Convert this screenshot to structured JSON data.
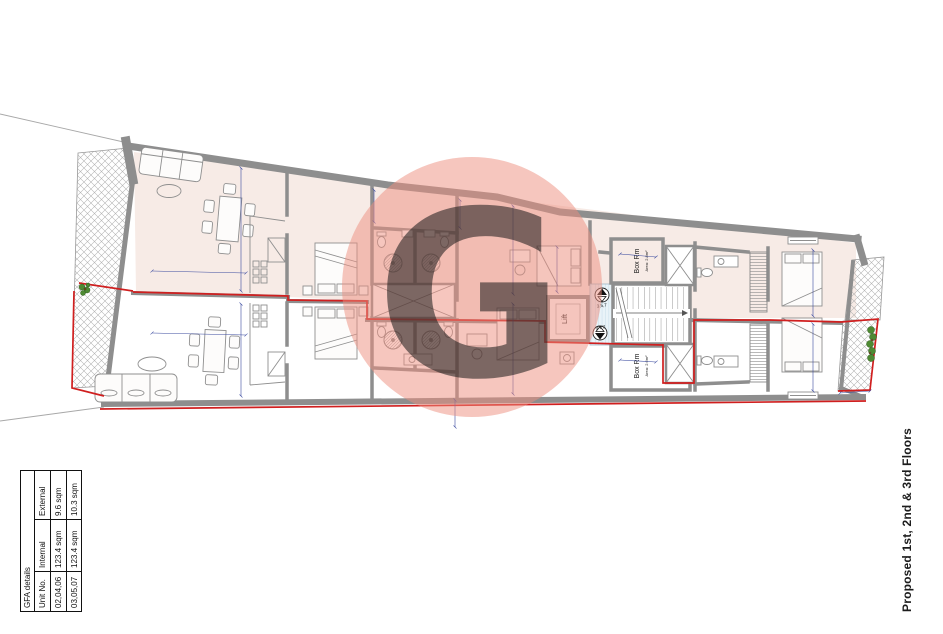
{
  "sheet": {
    "title_vertical": "Proposed 1st, 2nd & 3rd Floors"
  },
  "watermark": {
    "letter": "G",
    "color": "#ee8e7d"
  },
  "gfa_table": {
    "title": "GFA details",
    "columns": [
      "Unit No.",
      "Internal",
      "External"
    ],
    "rows": [
      {
        "unit_no": "02,04,06",
        "internal": "123.4 sqm",
        "external": "9.6 sqm"
      },
      {
        "unit_no": "03,05,07",
        "internal": "123.4 sqm",
        "external": "10.3 sqm"
      }
    ]
  },
  "plan": {
    "labels": {
      "lift": "Lift",
      "box_rm_top_name": "Box Rm",
      "box_rm_top_area": "Area: 2.8m²",
      "box_rm_bottom_name": "Box Rm",
      "box_rm_bottom_area": "Area: 2.6m²",
      "stairs_up_serves": "3,5,7",
      "stairs_down_serves": "2,4,6"
    },
    "colors": {
      "wall_grey": "#8e8e8e",
      "upper_unit_floor": "#f7ebe6",
      "unit_boundary_red": "#d01f1f",
      "dimension_blue": "#3a4a9f",
      "corridor_blue": "#e9f3f8",
      "plant_green": "#4e8a33"
    }
  }
}
